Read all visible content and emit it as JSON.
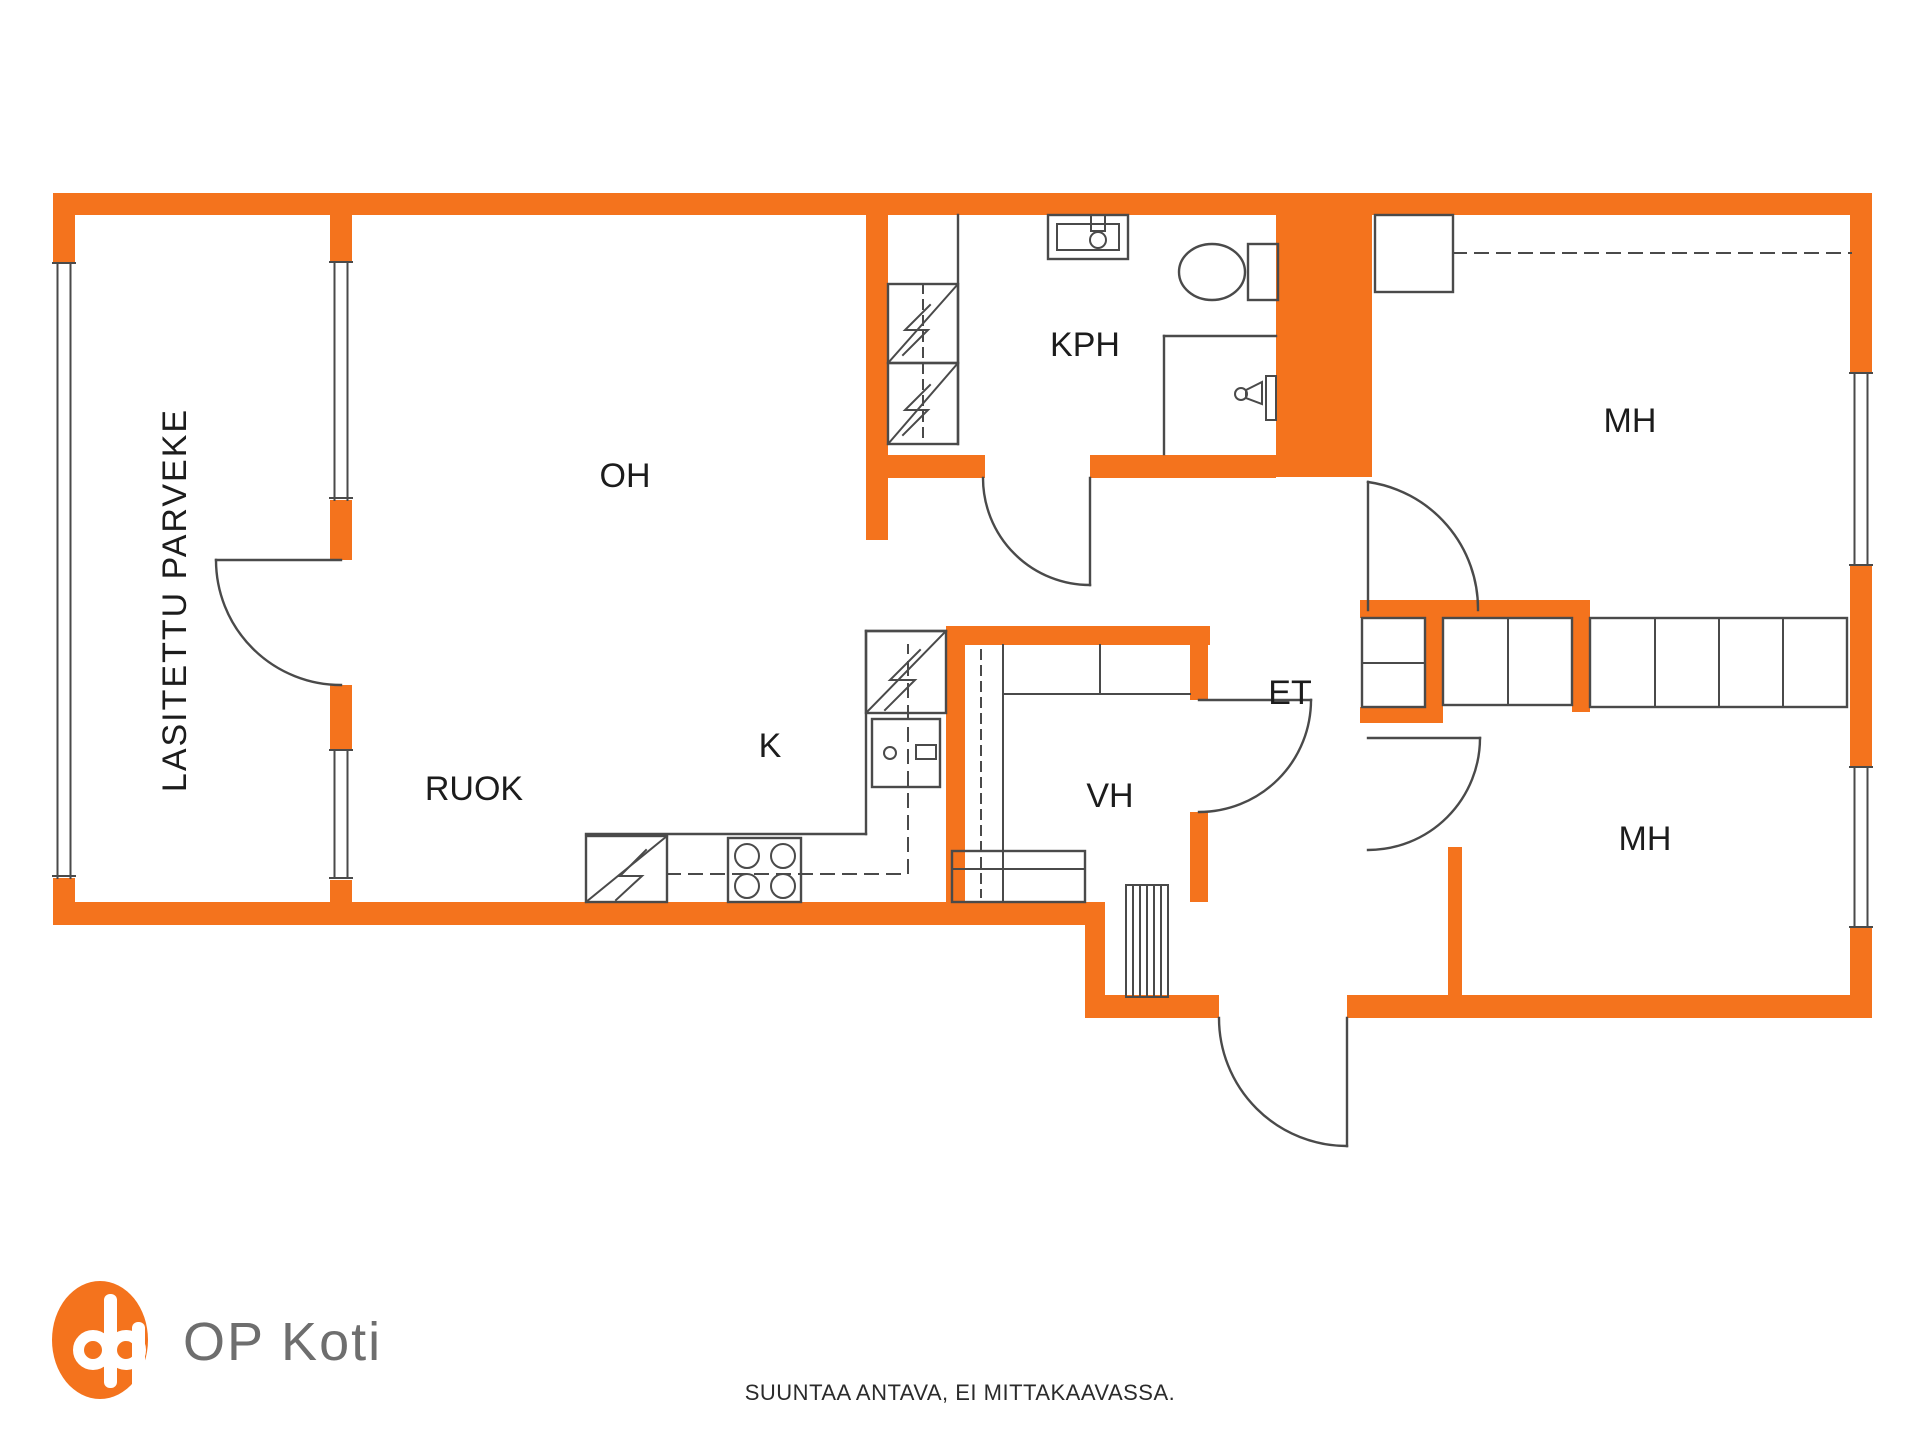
{
  "colors": {
    "accent": "#F4731D",
    "line": "#4A4A4A",
    "brand_text": "#6E6E6E",
    "label_text": "#1C1C1C"
  },
  "rooms": {
    "balcony": "LASITETTU PARVEKE",
    "living_room": "OH",
    "bathroom": "KPH",
    "bedroom_top": "MH",
    "dining": "RUOK",
    "kitchen": "K",
    "storage": "VH",
    "entry": "ET",
    "bedroom_bottom": "MH"
  },
  "footer": {
    "brand": "OP Koti",
    "disclaimer": "SUUNTAA ANTAVA, EI MITTAKAAVASSA."
  }
}
